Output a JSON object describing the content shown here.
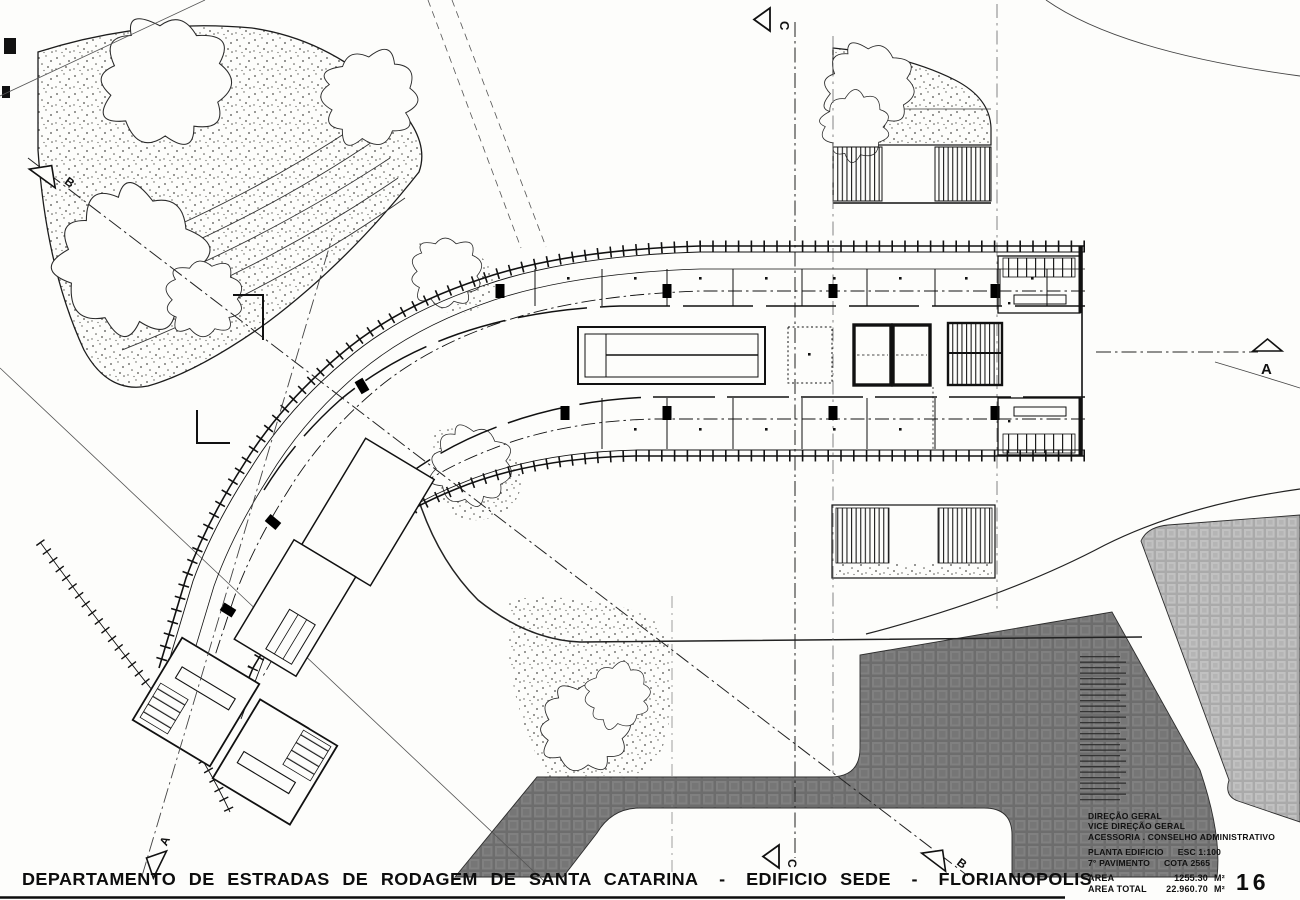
{
  "drawing_title": {
    "part1": "DEPARTAMENTO DE ESTRADAS DE RODAGEM DE SANTA CATARINA",
    "separator": "-",
    "part2": "EDIFICIO SEDE",
    "part3": "FLORIANOPOLIS"
  },
  "legend": {
    "org_lines": [
      "DIREÇÃO GERAL",
      "VICE DIREÇÃO GERAL",
      "ACESSORIA . CONSELHO ADMINISTRATIVO"
    ],
    "plan_label": "PLANTA EDIFICIO",
    "scale": "ESC 1:100",
    "floor": "7° PAVIMENTO",
    "cota": "COTA 2565",
    "area_label": "AREA",
    "area_value": "1255.30",
    "area_unit": "M²",
    "area_total_label": "AREA TOTAL",
    "area_total_value": "22.960.70",
    "area_total_unit": "M²",
    "sheet_number": "16"
  },
  "section_markers": {
    "top": "C",
    "bottom_center": "C",
    "left": "B",
    "bottom_right": "B",
    "right": "A",
    "bottom_left": "A"
  },
  "colors": {
    "ink": "#111111",
    "paper": "#fdfdfb",
    "dark_paving": "#787878",
    "light_paving": "#b8b8b8"
  }
}
